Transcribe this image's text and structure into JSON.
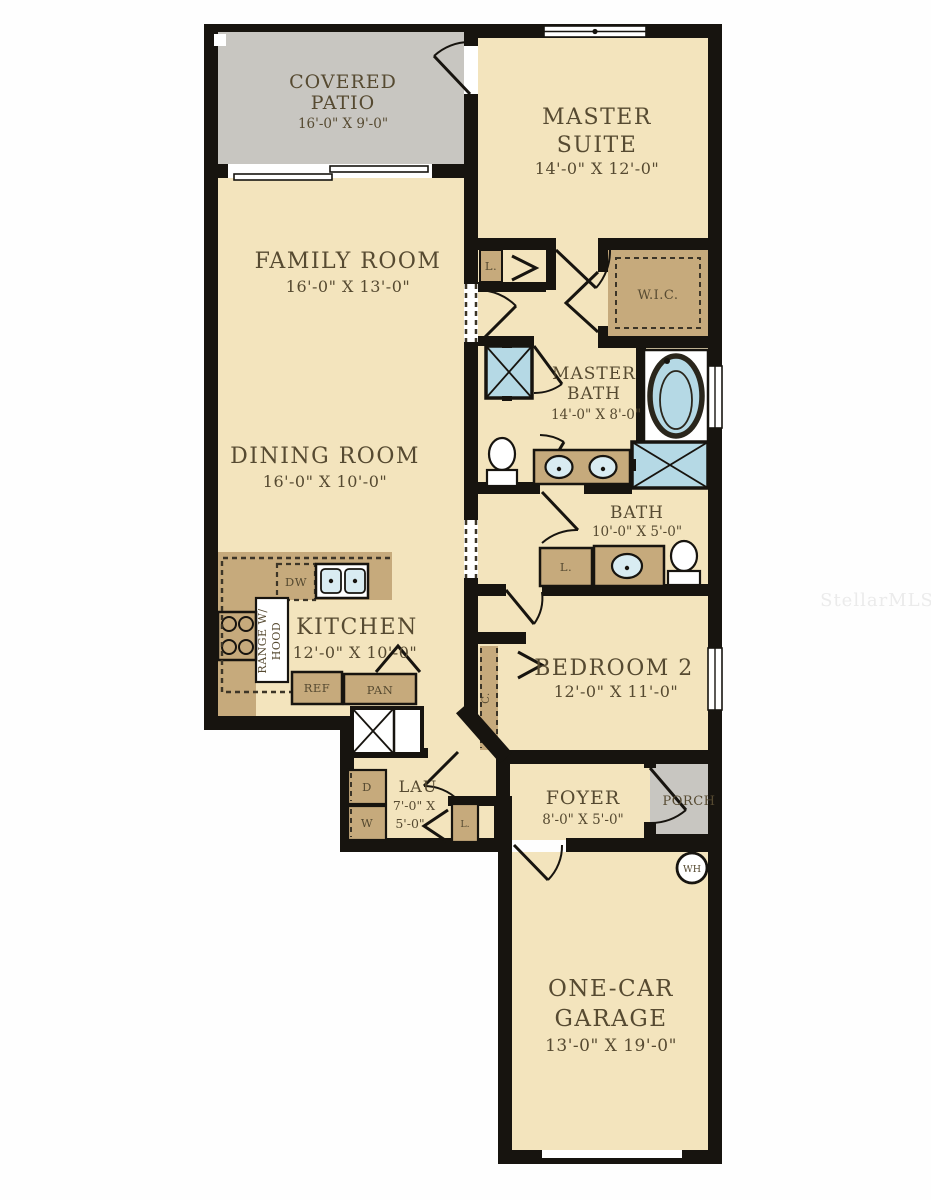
{
  "watermark": "StellarMLS",
  "colors": {
    "cream": "#f3e4bd",
    "tan": "#c6aa7c",
    "gray": "#c8c6c1",
    "blue": "#b5d9e5",
    "basin": "#d9ecf2",
    "wall": "#17140f",
    "dash": "#3c3527",
    "text": "#564a31",
    "watermark": "#ebebeb"
  },
  "rooms": {
    "covered_patio": {
      "line1": "COVERED",
      "line2": "PATIO",
      "dims": "16'-0\" X 9'-0\""
    },
    "master_suite": {
      "line1": "MASTER",
      "line2": "SUITE",
      "dims": "14'-0\" X 12'-0\""
    },
    "family_room": {
      "name": "FAMILY ROOM",
      "dims": "16'-0\" X 13'-0\""
    },
    "dining_room": {
      "name": "DINING ROOM",
      "dims": "16'-0\" X 10'-0\""
    },
    "wic": {
      "name": "W.I.C."
    },
    "master_bath": {
      "line1": "MASTER",
      "line2": "BATH",
      "dims": "14'-0\" X 8'-0\""
    },
    "bath": {
      "name": "BATH",
      "dims": "10'-0\" X 5'-0\""
    },
    "bedroom2": {
      "name": "BEDROOM 2",
      "dims": "12'-0\" X 11'-0\""
    },
    "kitchen": {
      "name": "KITCHEN",
      "dims": "12'-0\" X 10'-0\""
    },
    "laundry": {
      "name": "LAU",
      "dims_line1": "7'-0\" X",
      "dims_line2": "5'-0\""
    },
    "foyer": {
      "name": "FOYER",
      "dims": "8'-0\" X 5'-0\""
    },
    "porch": {
      "name": "PORCH"
    },
    "garage": {
      "line1": "ONE-CAR",
      "line2": "GARAGE",
      "dims": "13'-0\" X 19'-0\""
    }
  },
  "fixtures": {
    "linen_hall": "L.",
    "linen_bath": "L.",
    "linen_laundry": "L.",
    "closet": "C.",
    "dishwasher": "DW",
    "refrigerator": "REF",
    "pantry": "PAN",
    "range_line1": "RANGE W/",
    "range_line2": "HOOD",
    "dryer": "D",
    "washer": "W",
    "water_heater": "WH"
  }
}
